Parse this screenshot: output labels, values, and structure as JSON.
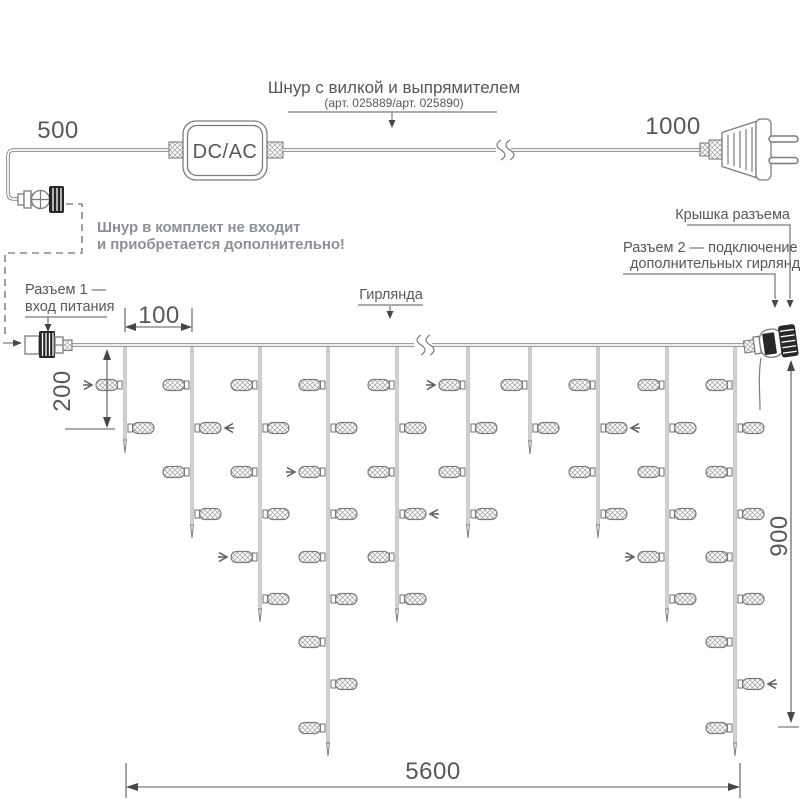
{
  "labels": {
    "cord_title": "Шнур с вилкой и выпрямителем",
    "cord_subtitle": "(арт. 025889/арт. 025890)",
    "dcac": "DC/AC",
    "note_line1": "Шнур в комплект не входит",
    "note_line2": "и приобретается дополнительно!",
    "connector1_line1": "Разъем 1 —",
    "connector1_line2": "вход питания",
    "garland": "Гирлянда",
    "cap": "Крышка разъема",
    "connector2_line1": "Разъем 2 — подключение",
    "connector2_line2": "дополнительных гирлянд"
  },
  "dimensions": {
    "cord_left": "500",
    "cord_right": "1000",
    "drop_spacing": "100",
    "first_drop": "200",
    "height": "900",
    "length": "5600"
  },
  "colors": {
    "line": "#7a7c7f",
    "text": "#55585c",
    "note_text": "#8d9196",
    "dark_parts": "#26282a",
    "background": "#ffffff"
  },
  "garland": {
    "wire_y": 345,
    "lamp_levels": [
      385,
      428,
      472,
      514,
      557,
      599,
      642,
      684,
      728
    ],
    "drops": [
      {
        "x": 125,
        "lamps": 2,
        "tip": 453
      },
      {
        "x": 192,
        "lamps": 4,
        "tip": 538
      },
      {
        "x": 260,
        "lamps": 6,
        "tip": 622
      },
      {
        "x": 328,
        "lamps": 9,
        "tip": 756
      },
      {
        "x": 397,
        "lamps": 6,
        "tip": 622
      },
      {
        "x": 468,
        "lamps": 4,
        "tip": 538
      },
      {
        "x": 530,
        "lamps": 2,
        "tip": 454
      },
      {
        "x": 598,
        "lamps": 4,
        "tip": 538
      },
      {
        "x": 667,
        "lamps": 6,
        "tip": 622
      },
      {
        "x": 735,
        "lamps": 9,
        "tip": 756
      }
    ],
    "arrows": [
      {
        "drop": 0,
        "level": 0,
        "side": "left"
      },
      {
        "drop": 1,
        "level": 1,
        "side": "right"
      },
      {
        "drop": 2,
        "level": 4,
        "side": "left"
      },
      {
        "drop": 3,
        "level": 2,
        "side": "left"
      },
      {
        "drop": 4,
        "level": 3,
        "side": "right"
      },
      {
        "drop": 5,
        "level": 0,
        "side": "left"
      },
      {
        "drop": 7,
        "level": 1,
        "side": "right"
      },
      {
        "drop": 8,
        "level": 4,
        "side": "left"
      },
      {
        "drop": 9,
        "level": 7,
        "side": "right"
      }
    ]
  }
}
